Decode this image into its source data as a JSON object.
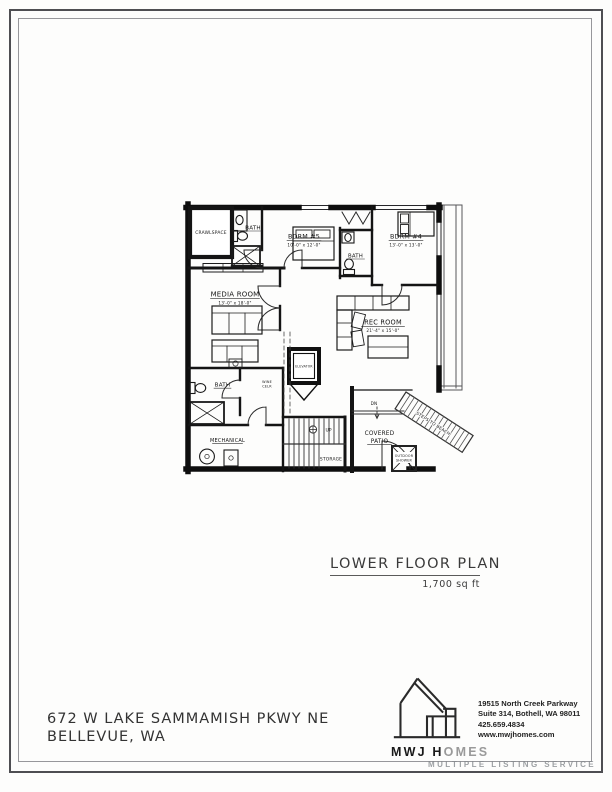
{
  "page": {
    "plan_title": "LOWER FLOOR PLAN",
    "plan_area": "1,700 sq ft",
    "address_line1": "672 W LAKE SAMMAMISH PKWY NE",
    "address_line2": "BELLEVUE, WA",
    "watermark": "MULTIPLE LISTING SERVICE"
  },
  "plan": {
    "rooms": {
      "crawlspace": "CRAWLSPACE",
      "bath_upper": "BATH",
      "bdrm5_label": "BDRM #5",
      "bdrm5_dims": "10'-0\" x 12'-0\"",
      "bath_mid": "BATH",
      "bdrm4_label": "BDRM #4",
      "bdrm4_dims": "13'-0\" x 13'-0\"",
      "media_label": "MEDIA ROOM",
      "media_dims": "13'-0\" x 18'-0\"",
      "rec_label": "REC ROOM",
      "rec_dims": "21'-4\" x 15'-0\"",
      "elevator": "ELEVATOR",
      "bath_lower": "BATH",
      "wine_line1": "WINE",
      "wine_line2": "CELR",
      "mechanical": "MECHANICAL",
      "storage": "STORAGE",
      "up": "UP",
      "dn": "DN",
      "covered_line1": "COVERED",
      "covered_line2": "PATIO",
      "steps_to_beach": "STEPS TO BEACH",
      "outdoor_line1": "OUTDOOR",
      "outdoor_line2": "SHOWER"
    }
  },
  "branding": {
    "logo_part_dark": "MWJ H",
    "logo_part_light": "OMES",
    "contact_line1": "19515 North Creek Parkway",
    "contact_line2": "Suite 314, Bothell, WA 98011",
    "contact_line3": "425.659.4834",
    "contact_line4": "www.mwjhomes.com"
  }
}
